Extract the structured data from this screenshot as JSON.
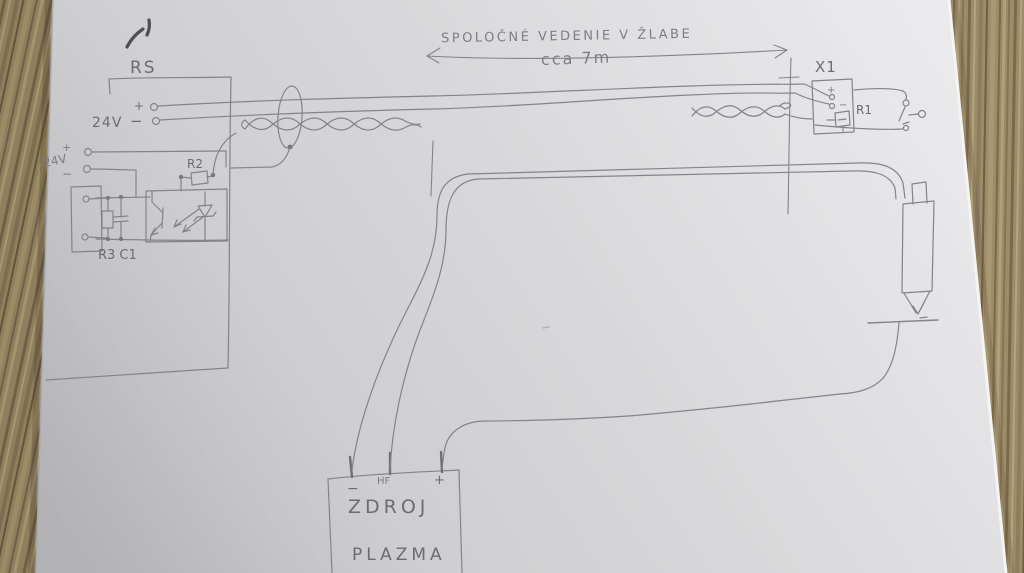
{
  "labels": {
    "title": "SPOLOČNÉ  VEDENIE   V ŽLABE",
    "length": "cca 7m",
    "rs": "RS",
    "x1": "X1",
    "r1": "R1",
    "r2": "R2",
    "r3c1": "R3 C1",
    "v24": "24V",
    "v24aux": "24V",
    "plus": "+",
    "minus": "−",
    "hf": "HF",
    "zdroj": "ZDROJ",
    "plazma": "PLAZMA"
  },
  "colors": {
    "pencil": "#83838a",
    "pencil_dark": "#4e4e54",
    "paper_light": "#ebebed",
    "paper_dark": "#c7c7cb",
    "wood_base": "#9c8c6a"
  }
}
